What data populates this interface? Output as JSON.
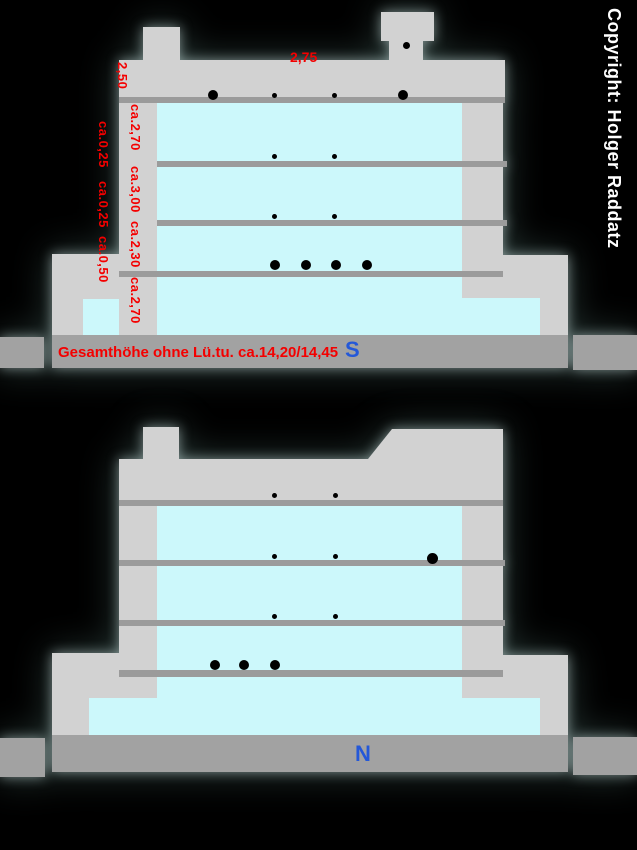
{
  "copyright": "Copyright: Holger Raddatz",
  "colors": {
    "dimension_red": "#f40000",
    "compass_blue": "#2458d8",
    "interior_cyan": "#ccf8fb",
    "building_gray": "#d2d2d2",
    "slab_gray": "#9b9b9b",
    "base_gray": "#a2a2a2"
  },
  "section_s": {
    "compass_label": "S",
    "roof_width": "2,75",
    "story_heights": [
      "2,50",
      "ca.2,70",
      "ca.3,00",
      "ca.2,30",
      "ca.2,70"
    ],
    "slab_offsets": [
      "ca.0,25",
      "ca.0,25",
      "ca.0,50"
    ],
    "total_height_note": "Gesamthöhe ohne Lü.tu. ca.14,20/14,45"
  },
  "section_n": {
    "compass_label": "N"
  }
}
